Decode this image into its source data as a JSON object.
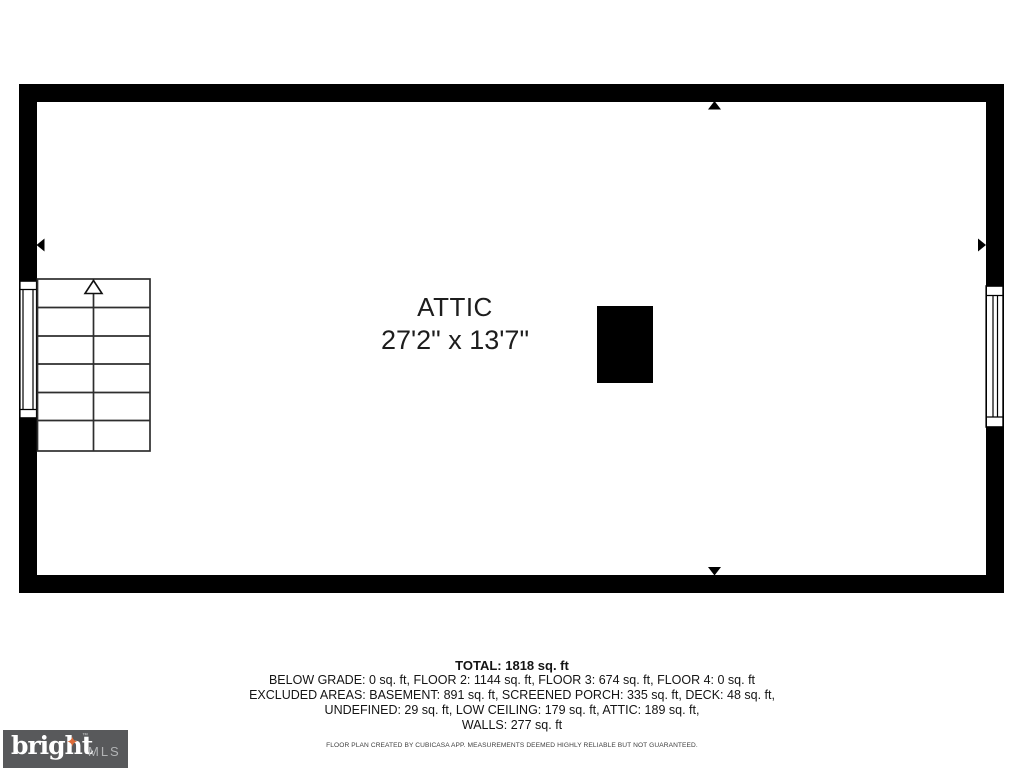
{
  "floorplan": {
    "room": {
      "name": "ATTIC",
      "dimensions": "27'2\" x 13'7\""
    },
    "wall_color": "#000000",
    "stair_line_color": "#2e2e2e"
  },
  "summary": {
    "total": "TOTAL: 1818 sq. ft",
    "lines": [
      "BELOW GRADE: 0 sq. ft, FLOOR 2: 1144 sq. ft, FLOOR 3: 674 sq. ft, FLOOR 4: 0 sq. ft",
      "EXCLUDED AREAS: BASEMENT: 891 sq. ft, SCREENED PORCH: 335 sq. ft, DECK: 48 sq. ft,",
      "UNDEFINED: 29 sq. ft, LOW CEILING: 179 sq. ft, ATTIC: 189 sq. ft,",
      "WALLS: 277 sq. ft"
    ],
    "disclaimer": "FLOOR PLAN CREATED BY CUBICASA APP. MEASUREMENTS DEEMED HIGHLY RELIABLE BUT NOT GUARANTEED."
  },
  "logo": {
    "brand": "bright",
    "trademark": "™",
    "star": "✦",
    "suffix": "MLS",
    "bg_color": "#58595b",
    "star_color": "#dd6b39"
  }
}
